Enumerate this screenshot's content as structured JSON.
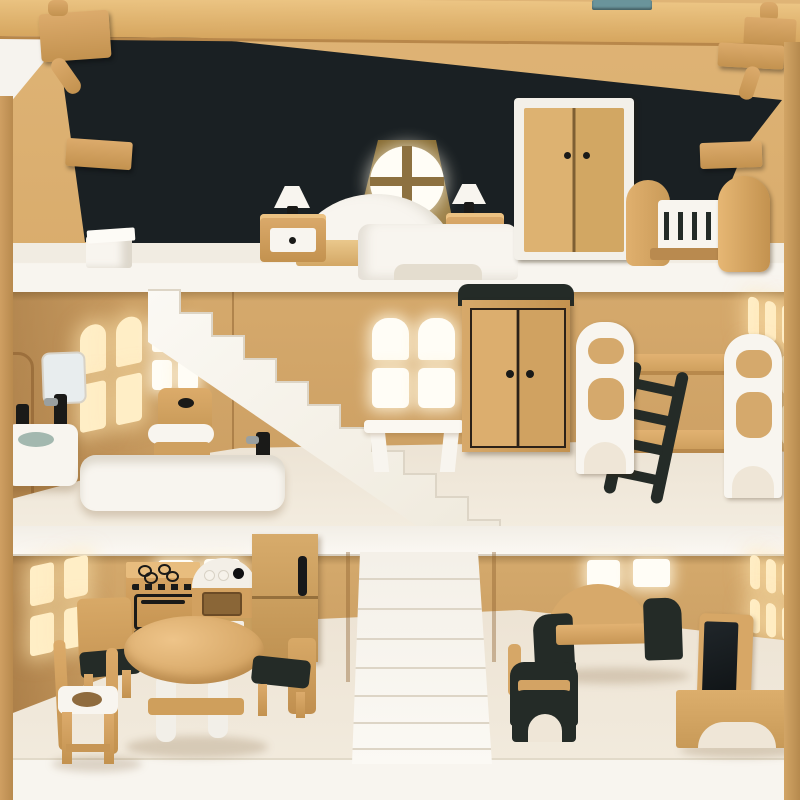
{
  "meta": {
    "type": "photograph",
    "subject": "three-story wooden toy dollhouse, open front, furnished with miniature wooden furniture"
  },
  "palette": {
    "paper": "#f6f3ee",
    "beam": "#ecc584",
    "beam-dark": "#d6a65f",
    "gable": "#dfb476",
    "wall-mid": "#d5a96c",
    "wall-low": "#cb9d61",
    "wall-dark": "#a97e46",
    "attic-wall": "#1a2023",
    "furn-wood": "#dcab6c",
    "furn-wood-dark": "#c3924f",
    "wood-edge": "#96703c",
    "white-furn": "#f8f5ef",
    "white-dim": "#e4ddcf",
    "slab": "#f8f5ef",
    "floor": "#efe6d7",
    "black-furn": "#242b27",
    "ink": "#1a1a18",
    "glow": "#ffeec6",
    "bright": "#fffdf6",
    "teal": "#6a949b",
    "basin": "#a3b8af",
    "mirror": "#e8edee",
    "dormer": "#8d7140",
    "shadow": "rgba(110,75,30,0.2)"
  },
  "scene": {
    "attic": {
      "room": "bedroom",
      "objects": [
        "ridge-beam",
        "metal-hinge",
        "roof-pegs",
        "dormer-round-window",
        "white-double-bed",
        "nightstand-with-lamp-left",
        "nightstand-with-lamp-right",
        "white-framed-wardrobe",
        "wooden-crib",
        "white-stool"
      ]
    },
    "middle_floor": {
      "room": "bathroom-and-bedroom",
      "objects": [
        "arched-side-window",
        "mirror",
        "wall-sink-with-black-faucet",
        "wooden-toilet",
        "white-bathtub",
        "white-diagonal-staircase",
        "four-pane-window",
        "white-desk",
        "wardrobe-black-top",
        "bunk-bed-white-panels",
        "dark-ladder",
        "slatted-right-window"
      ]
    },
    "ground_floor": {
      "room": "kitchen-and-living-room",
      "objects": [
        "side-window",
        "stove-with-oven",
        "sink-unit-with-knobs",
        "fridge",
        "round-dining-table",
        "chair-black-seat-left",
        "chair-black-seat-right",
        "white-seat-highchair",
        "center-staircase",
        "sofa-black-arms",
        "armchair-black-arms",
        "tv-on-bench",
        "square-back-windows",
        "slatted-right-window"
      ]
    }
  }
}
